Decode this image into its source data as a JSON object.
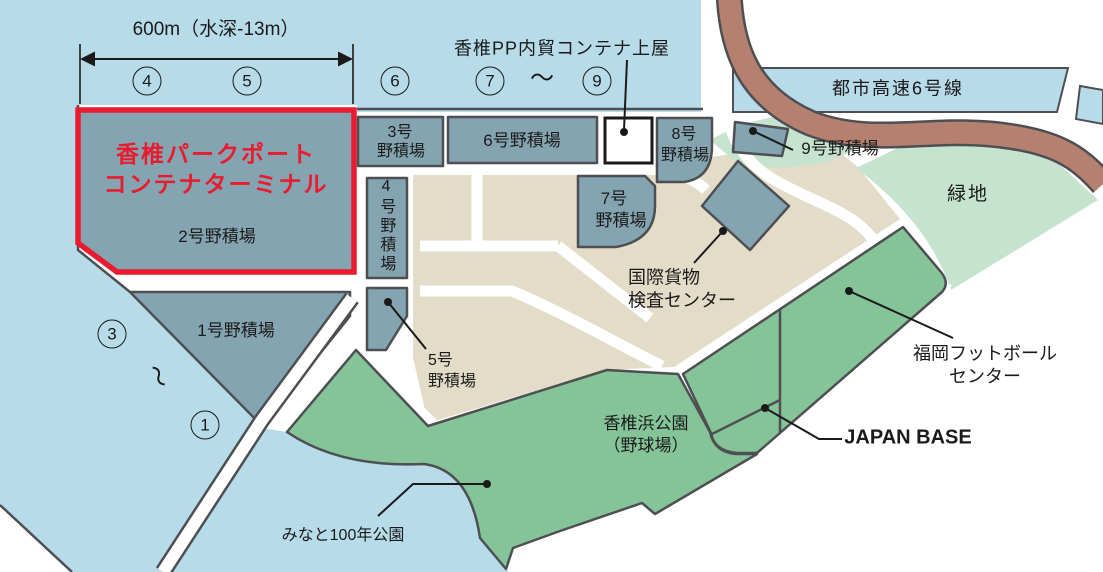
{
  "colors": {
    "sea": "#b8dbea",
    "yard_fill": "#85a4b1",
    "outline_gray": "#4d4f52",
    "tan_land": "#e3dcc8",
    "park_green": "#85c499",
    "pale_green": "#c6e3cf",
    "expressway_brown": "#b5806f",
    "highlight_red": "#e81c2e",
    "text": "#1a1a1a",
    "road_white": "#ffffff"
  },
  "scale_note": "600m（水深-13m）",
  "berths": {
    "top": [
      "4",
      "5",
      "6",
      "7",
      "9"
    ],
    "left": [
      "3",
      "1"
    ],
    "tilde": "～"
  },
  "shed_label": "香椎PP内貿コンテナ上屋",
  "expressway_label": "都市高速6号線",
  "terminal": {
    "name_line1": "香椎パークポート",
    "name_line2": "コンテナターミナル",
    "yard": "2号野積場"
  },
  "yards": {
    "y1": "1号野積場",
    "y3_line1": "3号",
    "y3_line2": "野積場",
    "y4": "4号野積場",
    "y5_line1": "5号",
    "y5_line2": "野積場",
    "y6": "6号野積場",
    "y7_line1": "7号",
    "y7_line2": "野積場",
    "y8_line1": "8号",
    "y8_line2": "野積場",
    "y9": "9号野積場"
  },
  "facilities": {
    "inspection_line1": "国際貨物",
    "inspection_line2": "検査センター",
    "greenspace": "緑地",
    "football_line1": "福岡フットボール",
    "football_line2": "センター",
    "japan_base": "JAPAN BASE",
    "park_line1": "香椎浜公園",
    "park_line2": "（野球場）",
    "minato_park": "みなと100年公園"
  }
}
